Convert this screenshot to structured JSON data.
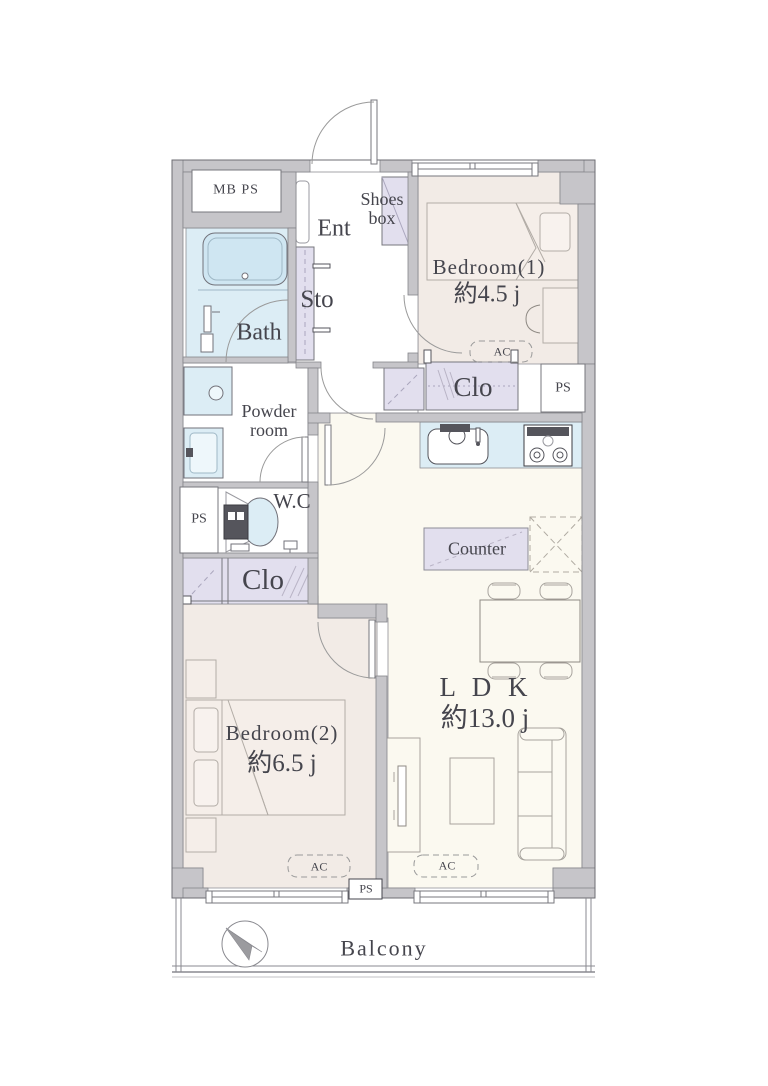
{
  "plan_title": "2LDK apartment floor plan",
  "rooms": {
    "bedroom1": {
      "label": "Bedroom(1)",
      "size": "約4.5 j"
    },
    "bedroom2": {
      "label": "Bedroom(2)",
      "size": "約6.5 j"
    },
    "ldk": {
      "label": "L D K",
      "size": "約13.0 j"
    },
    "bath": {
      "label": "Bath"
    },
    "powder": {
      "line1": "Powder",
      "line2": "room"
    },
    "wc": {
      "label": "W.C"
    },
    "entrance": {
      "label": "Ent"
    },
    "shoes_box": {
      "line1": "Shoes",
      "line2": "box"
    },
    "storage": {
      "label": "Sto"
    },
    "counter": {
      "label": "Counter"
    },
    "balcony": {
      "label": "Balcony"
    },
    "mbps": {
      "label": "MB PS"
    }
  },
  "labels": {
    "clo": "Clo",
    "ps": "PS",
    "ac": "AC"
  },
  "compass": {
    "points": "northwest"
  },
  "colors": {
    "wall": "#c6c5c9",
    "bedroom_floor": "#f2ebe6",
    "ldk_floor": "#fbf9f0",
    "water_area": "#dcedf5",
    "closet": "#e2dfee",
    "text": "#45454d"
  }
}
